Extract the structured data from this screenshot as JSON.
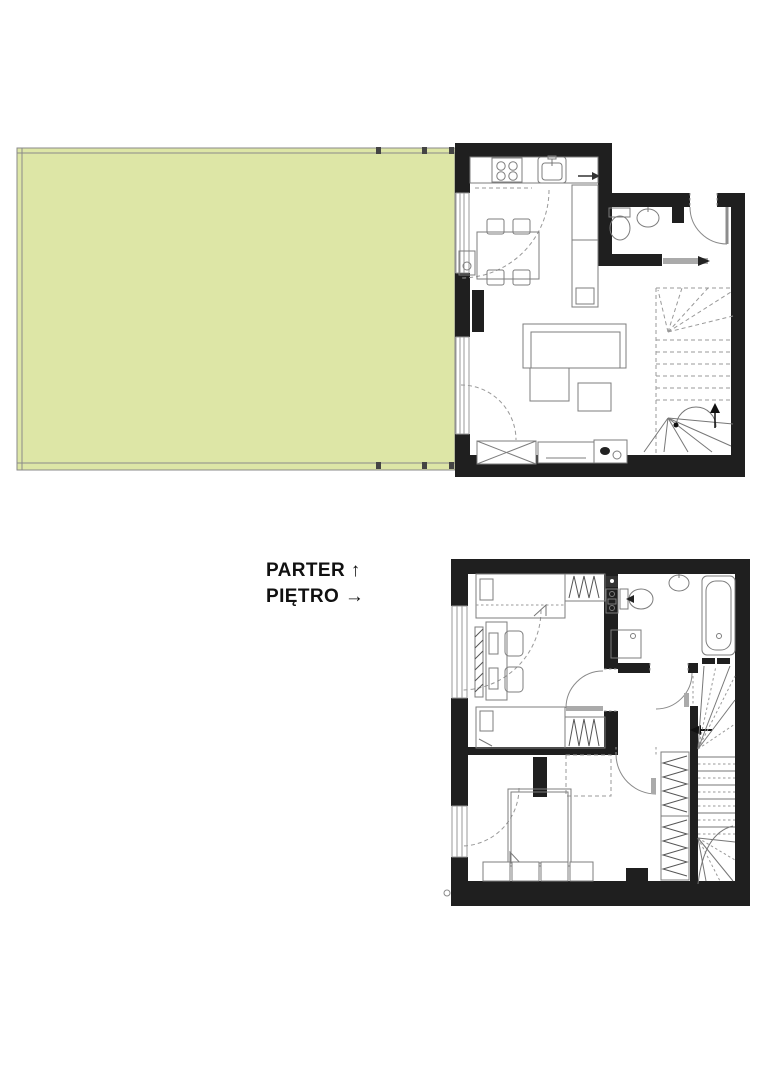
{
  "labels": {
    "ground_floor": {
      "text": "PARTER",
      "arrow": "↑"
    },
    "upper_floor": {
      "text": "PIĘTRO",
      "arrow": "→"
    }
  },
  "colors": {
    "garden_green": "#dde6a6",
    "wall_black": "#1f1f1f",
    "drawing_gray": "#8a8a8a",
    "background": "#ffffff"
  }
}
